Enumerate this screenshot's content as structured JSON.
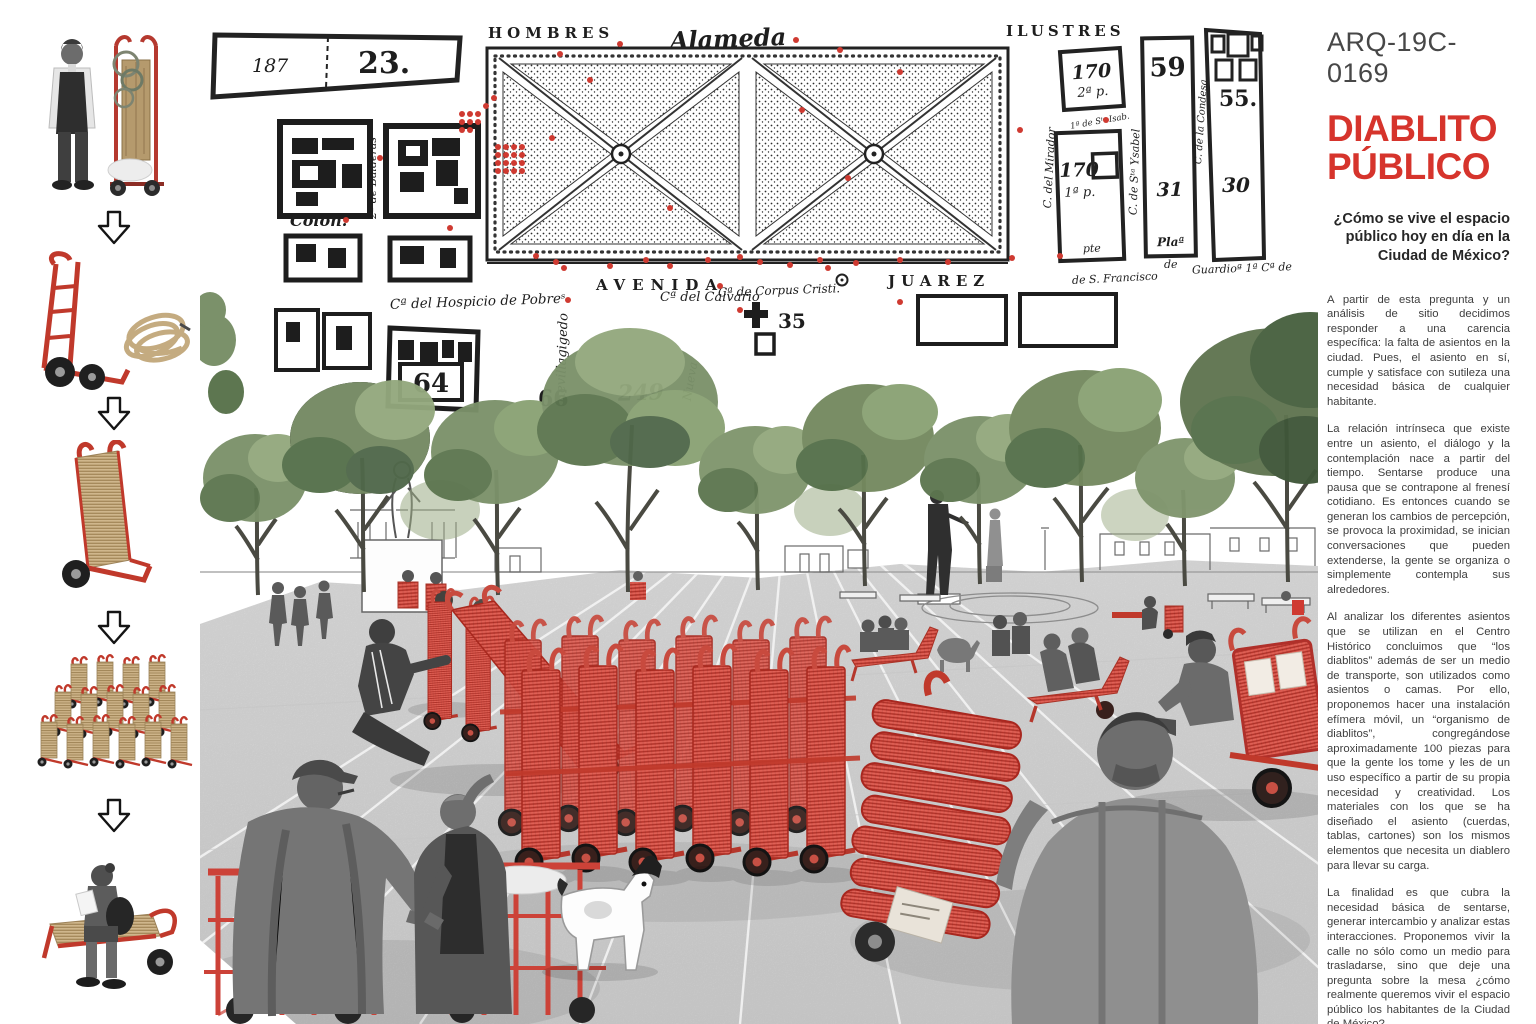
{
  "colors": {
    "accent_red": "#d6342c",
    "sketch_red": "#e06055",
    "map_ink": "#1e1e1e",
    "body_text": "#3e3e3e",
    "rope_tan": "#cfb68c",
    "tree_green": "#6f8159",
    "plaza_gray": "#d9d9d9",
    "red_dot": "#cf3a31"
  },
  "header": {
    "code": "ARQ-19C-0169",
    "title_line1": "DIABLITO",
    "title_line2": "PÚBLICO",
    "question": "¿Cómo se vive el espacio público hoy en día en la Ciudad de México?"
  },
  "article": {
    "paragraphs": [
      "A partir de esta pregunta y un análisis de sitio decidimos responder a una carencia específica: la falta de asientos en la ciudad. Pues, el asiento en sí, cumple y satisface con sutileza una necesidad básica de cualquier habitante.",
      "La relación intrínseca que existe entre un asiento, el diálogo y la contemplación nace a partir del tiempo. Sentarse produce una pausa que se contrapone al frenesí cotidiano. Es entonces cuando se generan los cambios de percepción, se provoca la proximidad, se inician conversaciones que pueden extenderse, la gente se organiza o simplemente contempla sus alrededores.",
      "Al analizar los diferentes asientos que se utilizan en el Centro Histórico concluimos que “los diablitos” además de ser un medio de transporte, son utilizados como asientos o camas. Por ello, proponemos hacer una instalación efímera móvil, un “organismo de diablitos”, congregándose aproximadamente 100 piezas para que la gente los tome y les de un uso específico a partir de su propia necesidad y creatividad. Los materiales con los que se ha diseñado el asiento (cuerdas, tablas, cartones) son los mismos elementos que necesita un diablero para llevar su carga.",
      "La finalidad es que cubra la necesidad básica de sentarse, generar intercambio y analizar estas interacciones. Proponemos vivir la calle no sólo como un medio para trasladarse, sino que deje una pregunta sobre la mesa ¿cómo realmente queremos vivir el espacio público los habitantes de la Ciudad de México?"
    ]
  },
  "process": {
    "arrow_icon": "double-down-arrow",
    "steps": [
      {
        "icon": "diablero-with-loaded-diablito"
      },
      {
        "icon": "red-handtruck-and-rope"
      },
      {
        "icon": "rope-woven-diablito"
      },
      {
        "icon": "diablito-cluster"
      },
      {
        "icon": "person-sitting-on-diablito"
      }
    ]
  },
  "map": {
    "labels": {
      "hombres": "HOMBRES",
      "alameda": "Alameda",
      "ilustres": "ILUSTRES",
      "n187": "187",
      "n23": "23.",
      "colon": "Colon.",
      "balderas": "2ª de Balderas",
      "avenida": "AVENIDA",
      "juarez": "JUAREZ",
      "hospicio": "Cª del Hospicio de Pobreˢ",
      "calvario": "Cª del Calvario",
      "corpus": "Cª de Corpus Cristi.",
      "n64": "64",
      "n66": "66",
      "n249": "249",
      "n35": "35",
      "revillagigedo": "Revillagigedo",
      "nueva": "Nueva",
      "mirador": "C. del Mirador",
      "sta_isab": "1ª de Sᵗᵃ Isab.",
      "n170a": "170",
      "n170a_sub": "2ª p.",
      "n170b": "170",
      "n170b_sub": "1ª p.",
      "pte": "pte",
      "sta_ysabel": "C. de Sᵗᵃ Ysabel",
      "n59": "59",
      "n31": "31",
      "plaza": "Plaª",
      "plaza_de": "de",
      "condesa": "C. de la Condesa",
      "n55": "55.",
      "n30": "30",
      "guardia": "Guardioª 1ª Cª de",
      "sfrancisco": "de S. Francisco"
    }
  }
}
